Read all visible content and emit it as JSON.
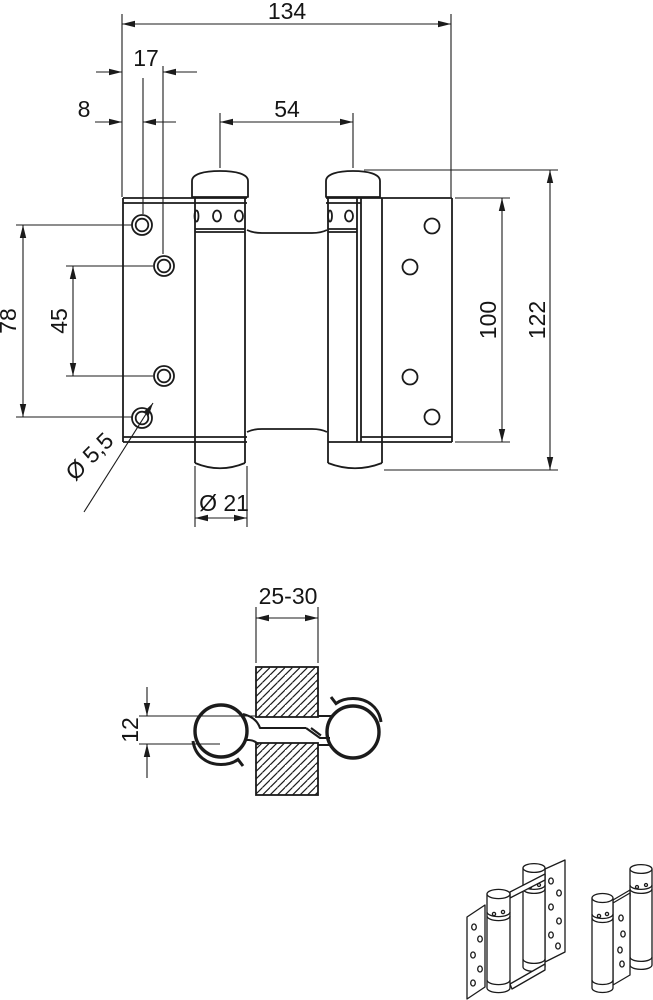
{
  "drawing": {
    "colors": {
      "line": "#1b1b1b",
      "background": "#ffffff"
    },
    "front_view": {
      "overall_width": "134",
      "hole_column_2_offset": "17",
      "hole_column_1_offset": "8",
      "barrel_spacing": "54",
      "hole_row_span": "78",
      "hole_row_inner_span": "45",
      "leaf_height": "100",
      "overall_height": "122",
      "screw_hole_diameter": "Ø 5,5",
      "barrel_diameter": "Ø 21"
    },
    "section_view": {
      "door_thickness": "25-30",
      "leaf_offset": "12"
    }
  }
}
